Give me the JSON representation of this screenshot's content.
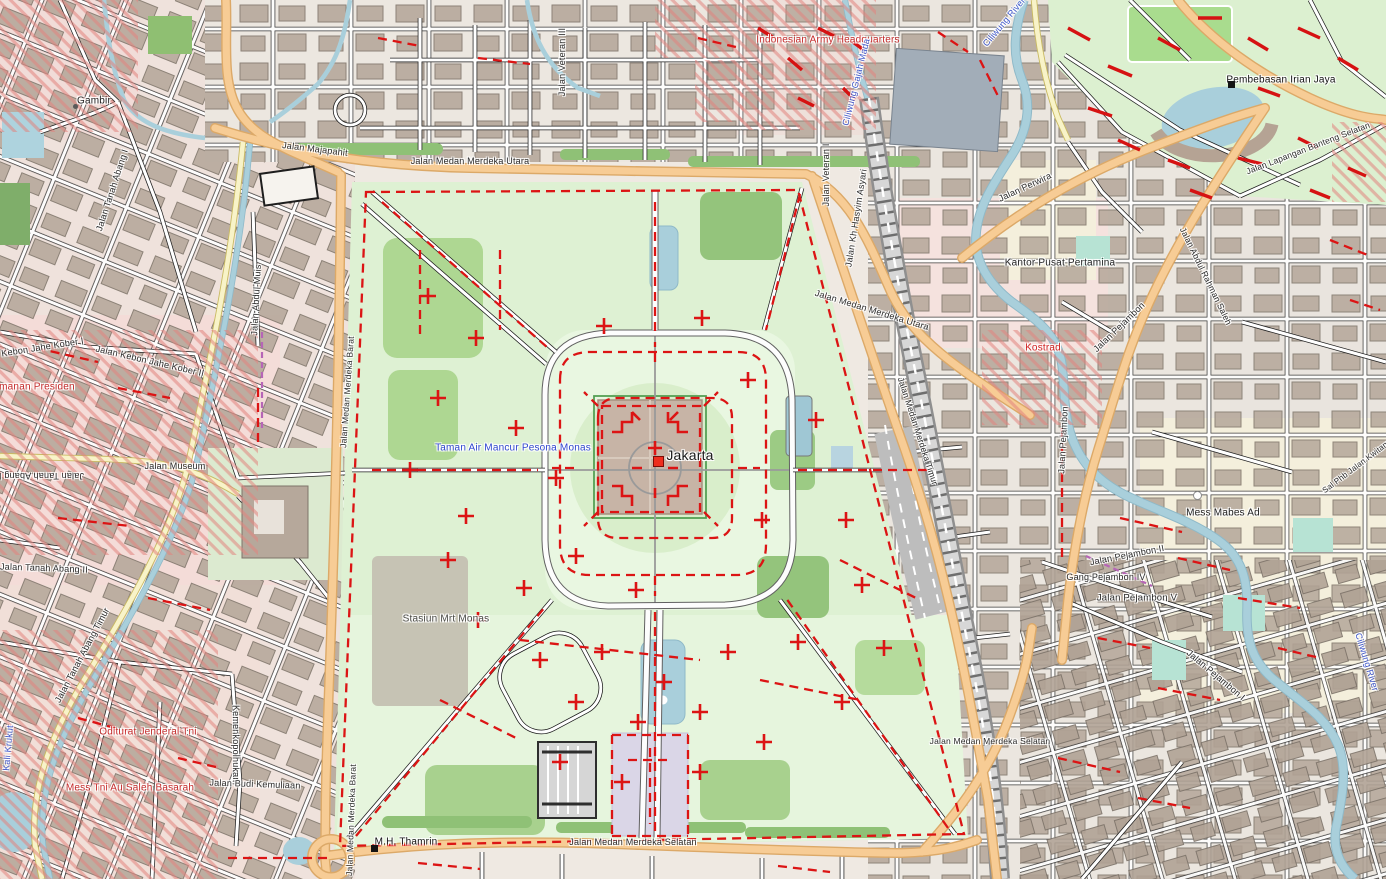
{
  "map": {
    "place_name": "Jakarta",
    "labels": [
      {
        "id": "label-city-jakarta",
        "text": "Jakarta",
        "x": 690,
        "y": 455,
        "rot": 0,
        "color": "#1a1a1a",
        "size": 14,
        "cls": "city"
      },
      {
        "id": "label-taman-air-mancur-pesona-monas",
        "text": "Taman Air Mancur Pesona Monas",
        "x": 513,
        "y": 448,
        "rot": 0,
        "color": "#2f45d0",
        "size": 10
      },
      {
        "id": "label-stasiun-mrt-monas",
        "text": "Stasiun Mrt Monas",
        "x": 446,
        "y": 619,
        "rot": 0,
        "color": "#4a4a46",
        "size": 10
      },
      {
        "id": "label-jalan-medan-merdeka-utara-w",
        "text": "Jalan Medan Merdeka Utara",
        "x": 470,
        "y": 161,
        "rot": 0,
        "color": "#2b2b2b",
        "size": 9
      },
      {
        "id": "label-jalan-medan-merdeka-utara-e",
        "text": "Jalan Medan Merdeka Utara",
        "x": 872,
        "y": 310,
        "rot": 17,
        "color": "#2b2b2b",
        "size": 9
      },
      {
        "id": "label-jalan-medan-merdeka-selatan-c",
        "text": "Jalan Medan Merdeka Selatan",
        "x": 633,
        "y": 842,
        "rot": 0,
        "color": "#2b2b2b",
        "size": 9
      },
      {
        "id": "label-jalan-medan-merdeka-selatan-e",
        "text": "Jalan Medan Merdeka Selatan",
        "x": 990,
        "y": 741,
        "rot": 0,
        "color": "#2b2b2b",
        "size": 8.5
      },
      {
        "id": "label-jalan-medan-merdeka-barat-n",
        "text": "Jalan Medan Merdeka Barat",
        "x": 347,
        "y": 392,
        "rot": -86,
        "color": "#2b2b2b",
        "size": 8.5
      },
      {
        "id": "label-jalan-medan-merdeka-barat-s",
        "text": "Jalan Medan Merdeka Barat",
        "x": 351,
        "y": 820,
        "rot": -88,
        "color": "#2b2b2b",
        "size": 8.5
      },
      {
        "id": "label-mh-thamrin",
        "text": "M.H. Thamrin",
        "x": 406,
        "y": 842,
        "rot": 0,
        "color": "#111111",
        "size": 10
      },
      {
        "id": "label-jalan-majapahit",
        "text": "Jalan Majapahit",
        "x": 315,
        "y": 149,
        "rot": 7,
        "color": "#2b2b2b",
        "size": 9
      },
      {
        "id": "label-gambir",
        "text": "Gambir",
        "x": 94,
        "y": 101,
        "rot": 0,
        "color": "#222222",
        "size": 10
      },
      {
        "id": "label-jalan-museum",
        "text": "Jalan Museum",
        "x": 175,
        "y": 466,
        "rot": 0,
        "color": "#2b2b2b",
        "size": 9
      },
      {
        "id": "label-jalan-kebon-jahe-kober-i",
        "text": "Jalan Kebon Jahe Kober I",
        "x": 30,
        "y": 349,
        "rot": -9,
        "color": "#2b2b2b",
        "size": 9
      },
      {
        "id": "label-jalan-kebon-jahe-kober-ii",
        "text": "Jalan Kebon Jahe Kober II",
        "x": 150,
        "y": 361,
        "rot": 13,
        "color": "#2b2b2b",
        "size": 9
      },
      {
        "id": "label-pengamanan-presiden",
        "text": "Pengamanan Presiden",
        "x": 22,
        "y": 387,
        "rot": 0,
        "color": "#c52b2b",
        "size": 10
      },
      {
        "id": "label-jalan-tanah-abang-ii-a",
        "text": "Jalan Tanah Abang II",
        "x": 44,
        "y": 568,
        "rot": 2,
        "color": "#2b2b2b",
        "size": 9
      },
      {
        "id": "label-jalan-tanah-abang-ii-b",
        "text": "Jalan Tanah Abang II",
        "x": 40,
        "y": 476,
        "rot": 180,
        "color": "#2b2b2b",
        "size": 9
      },
      {
        "id": "label-jalan-tanah-abang-timur",
        "text": "Jalan Tanah Abang Timur",
        "x": 82,
        "y": 655,
        "rot": -62,
        "color": "#2b2b2b",
        "size": 9
      },
      {
        "id": "label-jalan-tanah-abang-i",
        "text": "Jalan Tanah Abang I",
        "x": 112,
        "y": 190,
        "rot": -72,
        "color": "#2b2b2b",
        "size": 9
      },
      {
        "id": "label-oditurat-jenderal-tni",
        "text": "Oditurat Jenderal Tni",
        "x": 148,
        "y": 732,
        "rot": 0,
        "color": "#c52b2b",
        "size": 10
      },
      {
        "id": "label-mess-tni-au-saleh-basarah",
        "text": "Mess Tni Au Saleh Basarah",
        "x": 130,
        "y": 788,
        "rot": 0,
        "color": "#c52b2b",
        "size": 10
      },
      {
        "id": "label-kemenkopolhukam",
        "text": "Kemenkopolhukam",
        "x": 236,
        "y": 745,
        "rot": 90,
        "color": "#2b2b2b",
        "size": 9
      },
      {
        "id": "label-jalan-budi-kemuliaan",
        "text": "Jalan Budi Kemuliaan",
        "x": 255,
        "y": 784,
        "rot": 2,
        "color": "#2b2b2b",
        "size": 9
      },
      {
        "id": "label-jalan-abdul-muis",
        "text": "Jalan Abdul Muis",
        "x": 256,
        "y": 300,
        "rot": -87,
        "color": "#2b2b2b",
        "size": 9
      },
      {
        "id": "label-jalan-veteran-iii",
        "text": "Jalan Veteran III",
        "x": 562,
        "y": 62,
        "rot": -90,
        "color": "#2b2b2b",
        "size": 9
      },
      {
        "id": "label-jalan-veteran-i",
        "text": "Jalan Veteran I",
        "x": 826,
        "y": 175,
        "rot": -90,
        "color": "#2b2b2b",
        "size": 9
      },
      {
        "id": "label-jalan-kh-hasyim-asyari",
        "text": "Jalan Kh Hasyim Asyari",
        "x": 856,
        "y": 218,
        "rot": -81,
        "color": "#2b2b2b",
        "size": 9
      },
      {
        "id": "label-jalan-medan-merdeka-timur",
        "text": "Jalan Medan Merdeka Timur",
        "x": 918,
        "y": 431,
        "rot": 72,
        "color": "#2b2b2b",
        "size": 8.5
      },
      {
        "id": "label-indonesian-army-headquarters",
        "text": "Indonesian Army Headquarters",
        "x": 828,
        "y": 40,
        "rot": 0,
        "color": "#c52b2b",
        "size": 10
      },
      {
        "id": "label-ciliwung-gajah-mada",
        "text": "Ciliwung Gajah Mada",
        "x": 856,
        "y": 82,
        "rot": -76,
        "color": "#3f58cc",
        "size": 9
      },
      {
        "id": "label-ciliwung-river-north",
        "text": "Ciliwung River",
        "x": 1004,
        "y": 22,
        "rot": -50,
        "color": "#3f58cc",
        "size": 9
      },
      {
        "id": "label-jalan-perwira",
        "text": "Jalan Perwira",
        "x": 1025,
        "y": 187,
        "rot": -25,
        "color": "#2b2b2b",
        "size": 9
      },
      {
        "id": "label-kantor-pusat-pertamina",
        "text": "Kantor Pusat Pertamina",
        "x": 1060,
        "y": 263,
        "rot": 0,
        "color": "#222222",
        "size": 10
      },
      {
        "id": "label-kostrad",
        "text": "Kostrad",
        "x": 1043,
        "y": 348,
        "rot": 0,
        "color": "#cf2020",
        "size": 10
      },
      {
        "id": "label-jalan-pejambon-diagonal",
        "text": "Jalan Pejambon",
        "x": 1119,
        "y": 327,
        "rot": -44,
        "color": "#2b2b2b",
        "size": 9
      },
      {
        "id": "label-jalan-pejambon-vertical",
        "text": "Jalan Pejambon",
        "x": 1063,
        "y": 440,
        "rot": -87,
        "color": "#2b2b2b",
        "size": 9
      },
      {
        "id": "label-mess-mabes-ad",
        "text": "Mess Mabes Ad",
        "x": 1223,
        "y": 513,
        "rot": 0,
        "color": "#222222",
        "size": 10
      },
      {
        "id": "label-jalan-pejambon-ii",
        "text": "Jalan Pejambon II",
        "x": 1127,
        "y": 555,
        "rot": -11,
        "color": "#2b2b2b",
        "size": 9
      },
      {
        "id": "label-gang-pejambon-iv",
        "text": "Gang Pejambon IV",
        "x": 1106,
        "y": 577,
        "rot": 0,
        "color": "#2b2b2b",
        "size": 9
      },
      {
        "id": "label-jalan-pejambon-v",
        "text": "Jalan Pejambon V",
        "x": 1137,
        "y": 598,
        "rot": 0,
        "color": "#2b2b2b",
        "size": 9.5
      },
      {
        "id": "label-jalan-pejambon-i",
        "text": "Jalan Pejambon I",
        "x": 1216,
        "y": 675,
        "rot": 40,
        "color": "#2b2b2b",
        "size": 9
      },
      {
        "id": "label-pembebasan-irian-jaya",
        "text": "Pembebasan Irian Jaya",
        "x": 1281,
        "y": 80,
        "rot": 0,
        "color": "#111111",
        "size": 10
      },
      {
        "id": "label-jalan-lapangan-banteng-selatan",
        "text": "Jalan Lapangan Banteng Selatan",
        "x": 1308,
        "y": 148,
        "rot": -21,
        "color": "#2b2b2b",
        "size": 8.5
      },
      {
        "id": "label-jalan-abdul-rahman-saleh",
        "text": "Jalan Abdul Rahman Saleh",
        "x": 1206,
        "y": 276,
        "rot": 64,
        "color": "#2b2b2b",
        "size": 8.5
      },
      {
        "id": "label-sal-phb-jalan-kwitang",
        "text": "Sal Phb Jalan Kwitang",
        "x": 1357,
        "y": 466,
        "rot": -37,
        "color": "#2b2b2b",
        "size": 8
      },
      {
        "id": "label-ciliwung-river-southeast",
        "text": "Ciliwung River",
        "x": 1367,
        "y": 662,
        "rot": 73,
        "color": "#3f58cc",
        "size": 9
      },
      {
        "id": "label-kali-krukut",
        "text": "Kali Krukut",
        "x": 8,
        "y": 748,
        "rot": -85,
        "color": "#3f58cc",
        "size": 9
      }
    ],
    "markers": [
      {
        "id": "marker-jakarta",
        "shape": "square",
        "x": 658,
        "y": 461,
        "size": 11,
        "fill": "#ee2e1e",
        "stroke": "#7a0c06"
      },
      {
        "id": "marker-mh-thamrin",
        "shape": "square",
        "x": 374,
        "y": 848,
        "size": 7,
        "fill": "#141414",
        "stroke": "#141414"
      },
      {
        "id": "marker-pembebasan-irian-jaya",
        "shape": "square",
        "x": 1231,
        "y": 84,
        "size": 7,
        "fill": "#141414",
        "stroke": "#141414"
      },
      {
        "id": "marker-gambir",
        "shape": "dot",
        "x": 75,
        "y": 106,
        "size": 5,
        "fill": "#5a5a5a",
        "stroke": "#5a5a5a"
      },
      {
        "id": "marker-mess-mabes-ad",
        "shape": "ring",
        "x": 1197,
        "y": 495,
        "size": 9,
        "fill": "#ffffff",
        "stroke": "#8a8a8a"
      }
    ],
    "colors": {
      "background": "#efe9e2",
      "park_green": "#def1d3",
      "tree_green": "#aed792",
      "water": "#a9cfdb",
      "building": "#b6a89b",
      "road_orange": "#f7cc95",
      "road_yellow": "#f8f3c8",
      "road_white": "#ffffff",
      "railway_gray": "#bdbdbd",
      "overlay_red": "#dc1414",
      "military_hatch_red": "#e2837d",
      "residential_pink": "#f4dcd8",
      "label_blue": "#3f58cc",
      "label_red": "#c52b2b"
    }
  }
}
